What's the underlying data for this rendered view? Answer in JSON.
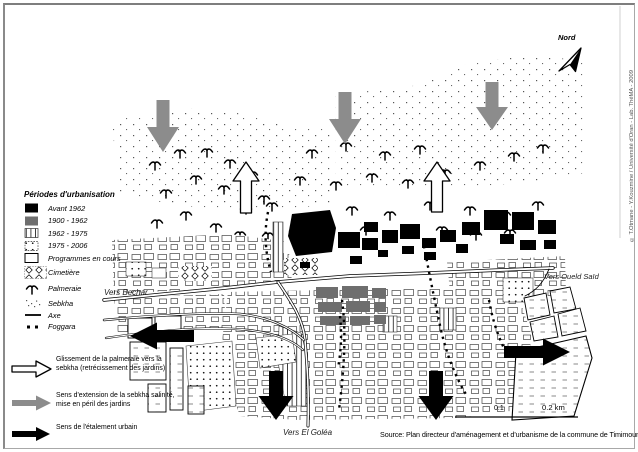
{
  "compass": {
    "label": "Nord"
  },
  "legend": {
    "title": "Périodes d'urbanisation",
    "items": [
      {
        "label": "Avant 1962"
      },
      {
        "label": "1900 - 1962"
      },
      {
        "label": "1962 - 1975"
      },
      {
        "label": "1975 - 2006"
      },
      {
        "label": "Programmes en cours"
      },
      {
        "label": "Cimetière"
      },
      {
        "label": "Palmeraie"
      },
      {
        "label": "Sebkha"
      },
      {
        "label": "Axe"
      },
      {
        "label": "Foggara"
      }
    ]
  },
  "arrow_legend": {
    "items": [
      {
        "label": "Glissement de la palmeraie vers la sebkha (retrécissement des jardins)"
      },
      {
        "label": "Sens d'extension de la sebkha salinité, mise en péril des jardins"
      },
      {
        "label": "Sens de l'étalement urbain"
      }
    ]
  },
  "map_labels": {
    "west": "Vers Bechar",
    "south": "Vers El Goléa",
    "east": "Vers Oueld Saïd"
  },
  "scale_bar": {
    "mid_label": "0.1",
    "end_label": "0.2 km"
  },
  "source": "Source: Plan directeur d'aménagement et d'urbanisme de la commune de Timimoun",
  "credit": "© T.Otmane - Y.Kouzmine / Université d'Oran - Lab. ThéMA - 2009",
  "colors": {
    "arrow_gray": "#8c8c8c",
    "fill_gray": "#6e6e6e",
    "black": "#000000"
  }
}
